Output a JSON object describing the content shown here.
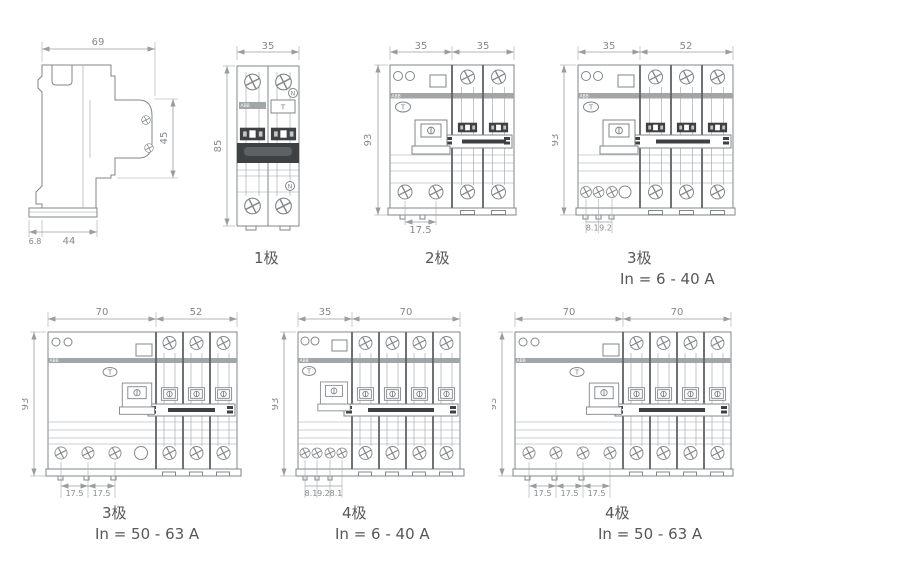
{
  "figure": {
    "side_view": {
      "dim_width_top": "69",
      "dim_height_right": "45",
      "dim_depth_bottom": "44",
      "dim_offset_bottom": "6.8"
    },
    "pole1": {
      "caption": "1极",
      "dim_width": "35",
      "dim_height": "85",
      "brand": "ABB",
      "test_button": "T",
      "neutral_top": "N",
      "neutral_bottom": "N"
    },
    "pole2": {
      "caption": "2极",
      "dim_width_left": "35",
      "dim_width_right": "35",
      "dim_height": "93",
      "dim_pitch_1": "17.5",
      "brand": "ABB",
      "test_button": "T"
    },
    "pole3_small": {
      "caption": "3极",
      "rating": "In = 6 - 40 A",
      "dim_width_left": "35",
      "dim_width_right": "52",
      "dim_height": "93",
      "dim_pitch_1": "8.1",
      "dim_pitch_2": "9.2",
      "brand": "ABB",
      "test_button": "T"
    },
    "pole3_large": {
      "caption": "3极",
      "rating": "In = 50 - 63 A",
      "dim_width_left": "70",
      "dim_width_right": "52",
      "dim_height": "93",
      "dim_pitch_1": "17.5",
      "dim_pitch_2": "17.5",
      "brand": "ABB",
      "test_button": "T"
    },
    "pole4_small": {
      "caption": "4极",
      "rating": "In = 6 - 40 A",
      "dim_width_left": "35",
      "dim_width_right": "70",
      "dim_height": "93",
      "dim_pitch_1": "8.1",
      "dim_pitch_2": "9.2",
      "dim_pitch_3": "8.1",
      "brand": "ABB",
      "test_button": "T"
    },
    "pole4_large": {
      "caption": "4极",
      "rating": "In = 50 - 63 A",
      "dim_width_left": "70",
      "dim_width_right": "70",
      "dim_height": "93",
      "dim_pitch_1": "17.5",
      "dim_pitch_2": "17.5",
      "dim_pitch_3": "17.5",
      "brand": "ABB",
      "test_button": "T"
    }
  },
  "colors": {
    "line": "#82878a",
    "dim_line": "#999da0",
    "dark_fill": "#3e4143",
    "brand_band": "#a2a6a8",
    "caption_text": "#54585a",
    "background": "#ffffff"
  }
}
